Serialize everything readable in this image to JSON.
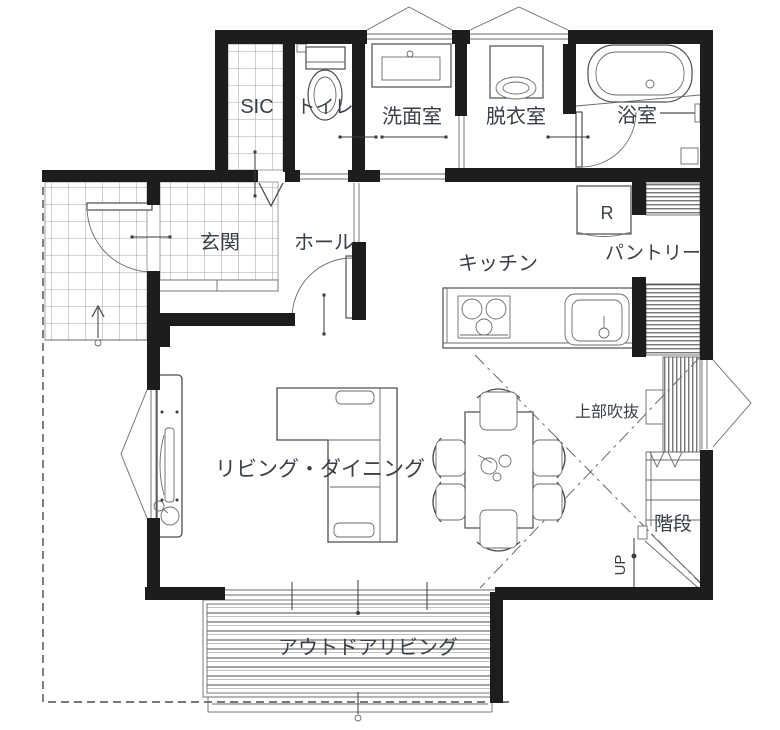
{
  "floor_plan": {
    "rooms": {
      "sic": "SIC",
      "toilet": "トイレ",
      "washroom": "洗面室",
      "dressing_room": "脱衣室",
      "bathroom": "浴室",
      "entrance": "玄関",
      "hall": "ホール",
      "kitchen": "キッチン",
      "pantry": "パントリー",
      "living_dining": "リビング・ダイニング",
      "open_ceiling": "上部吹抜",
      "stairs": "階段",
      "outdoor_living": "アウトドアリビング"
    },
    "annotations": {
      "stairs_direction": "UP",
      "refrigerator": "R"
    },
    "colors": {
      "background": "#ffffff",
      "wall": "#1d1d1b",
      "line": "#4d4d4d",
      "label": "#3a4048"
    }
  }
}
